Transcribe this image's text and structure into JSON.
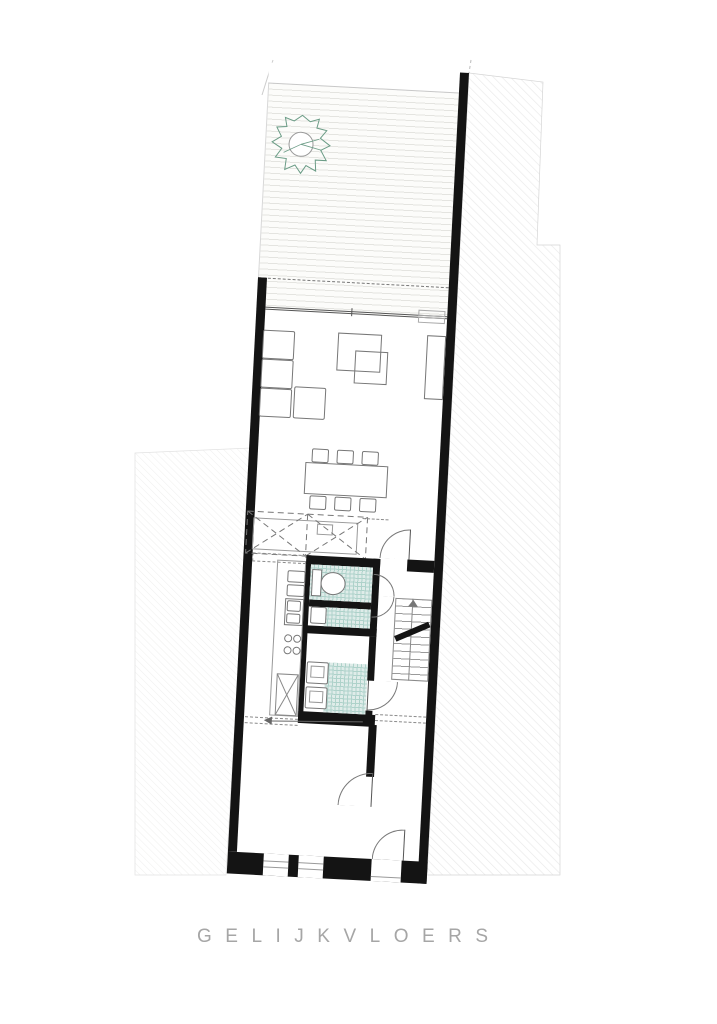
{
  "title": {
    "label": "GELIJKVLOERS"
  },
  "colors": {
    "wall": "#141414",
    "line": "#777777",
    "line_dark": "#555555",
    "tile_fill": "#dfece9",
    "tile_grid": "#aed2ca",
    "deck_line": "#e4e4e0",
    "tree_stroke": "#6b9c86",
    "title_text": "#a6a6a6",
    "hatch_line": "#e9e9e9"
  },
  "plan": {
    "floor_label": "GELIJKVLOERS",
    "rotation_deg": 3
  }
}
